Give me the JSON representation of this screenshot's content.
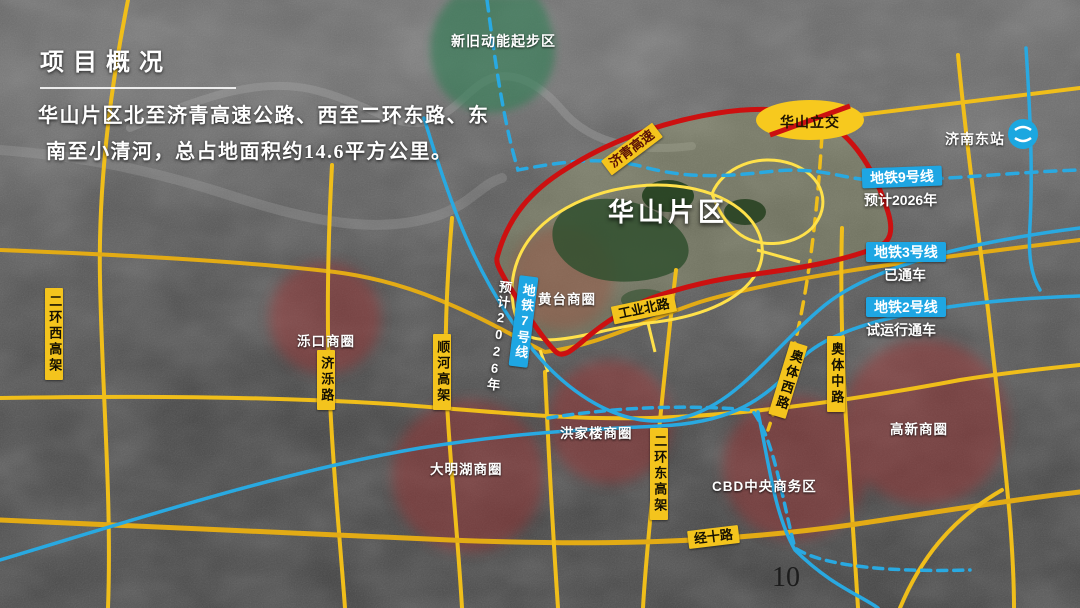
{
  "slide": {
    "title": "项目概况",
    "description": {
      "line1": "华山片区北至济青高速公路、西至二环东路、东",
      "line2": "南至小清河，总占地面积约14.6平方公里。"
    },
    "page_number": "10"
  },
  "map": {
    "region": {
      "name": "华山片区"
    },
    "zone": {
      "name": "新旧动能起步区"
    },
    "interchange": {
      "name": "华山立交"
    },
    "station": {
      "name": "济南东站",
      "icon": "metro-logo"
    },
    "highway": {
      "name": "济青高速"
    },
    "metro": {
      "line9": {
        "name": "地铁9号线",
        "status": "预计2026年"
      },
      "line3": {
        "name": "地铁3号线",
        "status": "已通车"
      },
      "line2": {
        "name": "地铁2号线",
        "status": "试运行通车"
      },
      "line7": {
        "name": "地铁7号线",
        "status": "预计2026年"
      }
    },
    "roads": {
      "erhuanxi": "二环西高架",
      "jiluo": "济泺路",
      "shunhe": "顺河高架",
      "gongyebei": "工业北路",
      "erhuandong": "二环东高架",
      "aotixi": "奥体西路",
      "aotizhong": "奥体中路",
      "jingshi": "经十路"
    },
    "districts": {
      "luokou": "泺口商圈",
      "huangtai": "黄台商圈",
      "hongjialou": "洪家楼商圈",
      "daminghu": "大明湖商圈",
      "cbd": "CBD中央商务区",
      "gaoxin": "高新商圈"
    },
    "colors": {
      "road_yellow": "#f0be1a",
      "metro_cyan": "#29a9e1",
      "boundary_red": "#cc1010",
      "district_circle_red": "#a23030",
      "zone_green": "#2f7d52",
      "badge_yellow": "#f4c41d"
    }
  }
}
